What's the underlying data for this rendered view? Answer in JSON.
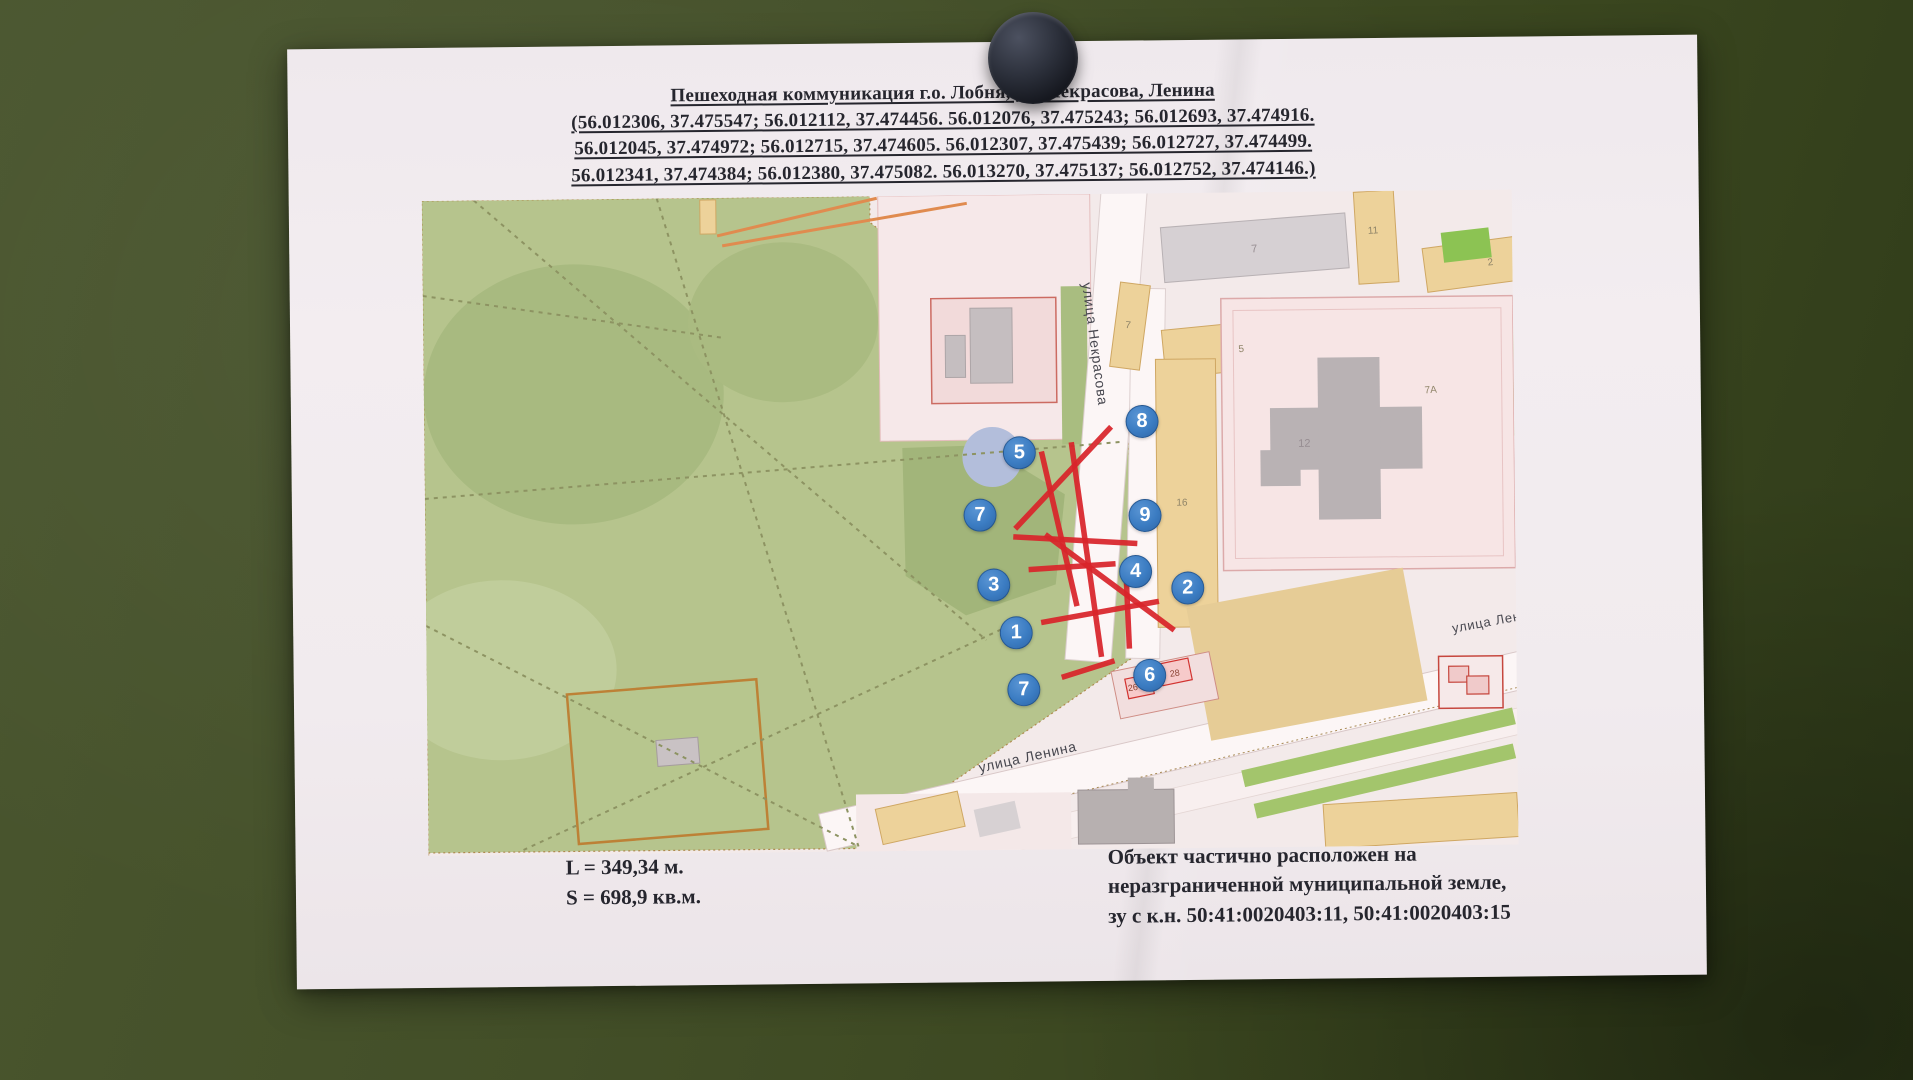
{
  "document": {
    "title": "Пешеходная коммуникация г.о. Лобня, ул. Некрасова, Ленина",
    "coords": [
      "(56.012306, 37.475547; 56.012112, 37.474456. 56.012076, 37.475243; 56.012693, 37.474916.",
      "56.012045, 37.474972; 56.012715, 37.474605. 56.012307, 37.475439; 56.012727, 37.474499.",
      "56.012341, 37.474384; 56.012380, 37.475082. 56.013270, 37.475137; 56.012752, 37.474146.)"
    ],
    "measurements": {
      "length": "L = 349,34 м.",
      "area": "S = 698,9 кв.м."
    },
    "note": [
      "Объект частично расположен на",
      "неразграниченной муниципальной земле,",
      "зу с к.н. 50:41:0020403:11, 50:41:0020403:15"
    ]
  },
  "map": {
    "colors": {
      "park": "#b6c48d",
      "streets_bg": "#f3eaea",
      "red_path": "#d9252b",
      "marker_blue": "#3b7cc2",
      "tan_building": "#edd29a",
      "pond": "#b3bedb"
    },
    "labels": [
      {
        "t": "улица Некрасова",
        "x": 672,
        "y": 150,
        "r": 83,
        "s": 14,
        "c": "street"
      },
      {
        "t": "улица Ленина",
        "x": 600,
        "y": 562,
        "r": -12,
        "s": 14,
        "c": "street"
      },
      {
        "t": "улица Ленина",
        "x": 1072,
        "y": 430,
        "r": -10,
        "s": 13,
        "c": "street"
      },
      {
        "t": "7",
        "x": 832,
        "y": 57,
        "r": -4,
        "s": 11,
        "c": "gray"
      },
      {
        "t": "7",
        "x": 705,
        "y": 132,
        "r": 6,
        "s": 10,
        "c": ""
      },
      {
        "t": "11",
        "x": 951,
        "y": 40,
        "r": -3,
        "s": 10,
        "c": ""
      },
      {
        "t": "2",
        "x": 1068,
        "y": 73,
        "r": -7,
        "s": 10,
        "c": ""
      },
      {
        "t": "5",
        "x": 818,
        "y": 157,
        "r": -5,
        "s": 10,
        "c": ""
      },
      {
        "t": "7А",
        "x": 1007,
        "y": 200,
        "r": -3,
        "s": 10,
        "c": ""
      },
      {
        "t": "12",
        "x": 880,
        "y": 252,
        "r": 0,
        "s": 11,
        "c": "gray"
      },
      {
        "t": "16",
        "x": 757,
        "y": 310,
        "r": 0,
        "s": 10,
        "c": ""
      },
      {
        "t": "26",
        "x": 706,
        "y": 494,
        "r": -8,
        "s": 9,
        "c": "red"
      },
      {
        "t": "28",
        "x": 748,
        "y": 480,
        "r": -8,
        "s": 9,
        "c": "red"
      }
    ],
    "markers": [
      {
        "n": "8",
        "x": 718,
        "y": 228
      },
      {
        "n": "5",
        "x": 595,
        "y": 258
      },
      {
        "n": "7",
        "x": 555,
        "y": 320
      },
      {
        "n": "9",
        "x": 720,
        "y": 322
      },
      {
        "n": "4",
        "x": 710,
        "y": 378
      },
      {
        "n": "2",
        "x": 762,
        "y": 395
      },
      {
        "n": "3",
        "x": 568,
        "y": 390
      },
      {
        "n": "1",
        "x": 590,
        "y": 438
      },
      {
        "n": "7",
        "x": 597,
        "y": 495
      },
      {
        "n": "6",
        "x": 723,
        "y": 482
      }
    ],
    "red_segments": [
      [
        687,
        233,
        590,
        334
      ],
      [
        647,
        248,
        675,
        463
      ],
      [
        617,
        257,
        651,
        412
      ],
      [
        588,
        342,
        712,
        350
      ],
      [
        603,
        375,
        690,
        370
      ],
      [
        620,
        340,
        748,
        437
      ],
      [
        615,
        428,
        733,
        408
      ],
      [
        700,
        368,
        703,
        455
      ],
      [
        635,
        483,
        688,
        467
      ]
    ],
    "dashed_paths": [
      [
        52,
        0,
        560,
        445
      ],
      [
        235,
        0,
        430,
        650
      ],
      [
        0,
        298,
        700,
        248
      ],
      [
        0,
        425,
        430,
        650
      ],
      [
        95,
        650,
        585,
        430
      ],
      [
        0,
        95,
        300,
        140
      ]
    ]
  }
}
